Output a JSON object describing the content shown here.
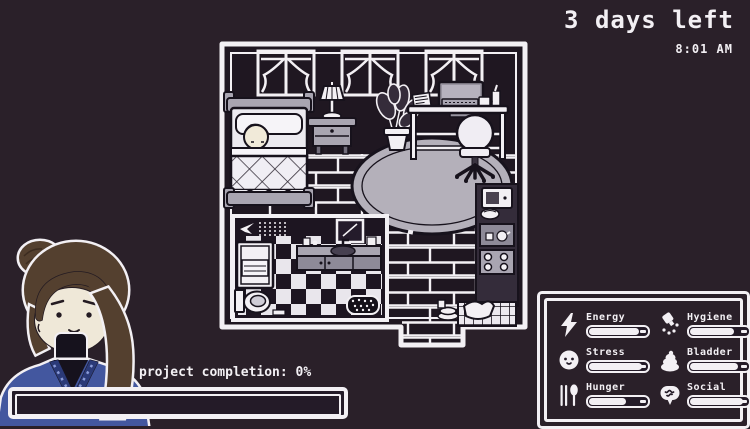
{
  "hud": {
    "days_left": "3 days left",
    "time": "8:01 AM"
  },
  "project": {
    "label": "project completion: 0%",
    "percent": 0
  },
  "stats": {
    "items": [
      {
        "id": "energy",
        "label": "Energy",
        "icon": "lightning-icon",
        "value": 84
      },
      {
        "id": "stress",
        "label": "Stress",
        "icon": "happy-face-icon",
        "value": 88
      },
      {
        "id": "hunger",
        "label": "Hunger",
        "icon": "cutlery-icon",
        "value": 62
      },
      {
        "id": "hygiene",
        "label": "Hygiene",
        "icon": "shower-head-icon",
        "value": 74
      },
      {
        "id": "bladder",
        "label": "Bladder",
        "icon": "poop-icon",
        "value": 80
      },
      {
        "id": "social",
        "label": "Social",
        "icon": "speech-bubble-icon",
        "value": 88
      }
    ]
  },
  "room": {
    "objects": [
      "window",
      "bed-with-sleeping-character",
      "nightstand",
      "table-lamp",
      "potted-plant",
      "desk",
      "computer-monitor",
      "keyboard",
      "papers",
      "desk-chair",
      "rug",
      "bathroom",
      "poster",
      "shower",
      "toilet",
      "sink-counter",
      "mirror",
      "bath-mat",
      "microwave",
      "kitchen-shelf",
      "stove",
      "floor-tiles",
      "laundry-pile",
      "dishes"
    ]
  },
  "colors": {
    "background": "#2a2029",
    "wall": "#1f1721",
    "white": "#f3f0f4",
    "gray": "#a9a5b1",
    "rug": "#b4b0ba",
    "hair": "#54402f",
    "skin": "#efe8d8",
    "sweater": "#43579f",
    "sweater_dark": "#2b3a78"
  }
}
